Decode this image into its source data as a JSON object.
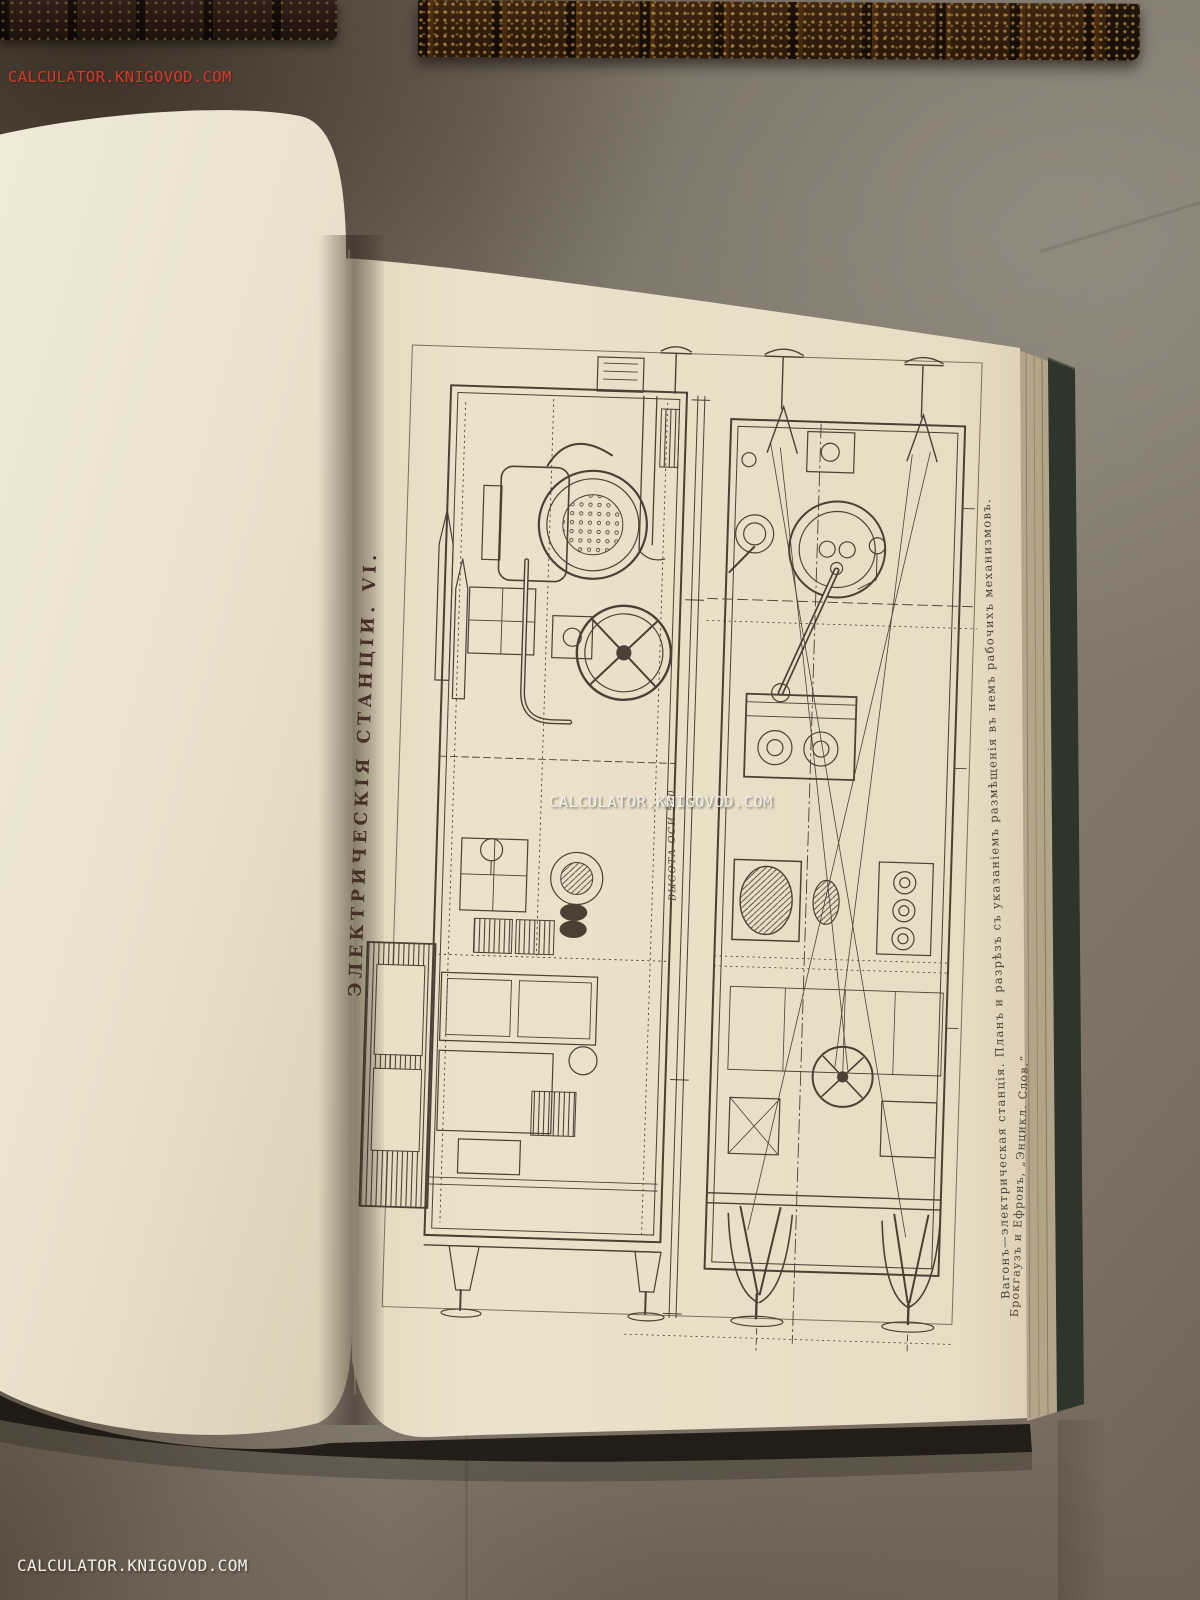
{
  "photo": {
    "subject": "open antique encyclopedia volume with engraved plate, two gilt-tooled book spines above",
    "watermarks": {
      "top_left": "CALCULATOR.KNIGOVOD.COM",
      "center": "CALCULATOR.KNIGOVOD.COM",
      "bottom_left": "CALCULATOR.KNIGOVOD.COM"
    }
  },
  "plate": {
    "title": "ЭЛЕКТРИЧЕСКІЯ СТАНЦІИ. VI.",
    "caption": "Вагонъ—электрическая станція. Планъ и разрѣзъ съ указаніемъ размѣщенія въ немъ рабочихъ механизмовъ.",
    "attribution": "Брокгаузъ и Ефронъ, „Энцикл. Слов.“",
    "dimension_label": "ВЫСОТА ОСИ 500"
  },
  "colors": {
    "table_gray": "#7b7266",
    "table_brown_dark": "#4a3a2b",
    "page_cream": "#ece4d1",
    "plate_paper": "#e9e0c8",
    "ink_sepia": "#4a4034",
    "title_ink": "#433026",
    "cover_green": "#2e362b",
    "fore_edge_tan": "#b2a58a",
    "spine_leather": "#3b2412",
    "spine_gold": "#d4aa48",
    "watermark_white": "#f4f1ea",
    "watermark_red": "#d43a2c"
  }
}
